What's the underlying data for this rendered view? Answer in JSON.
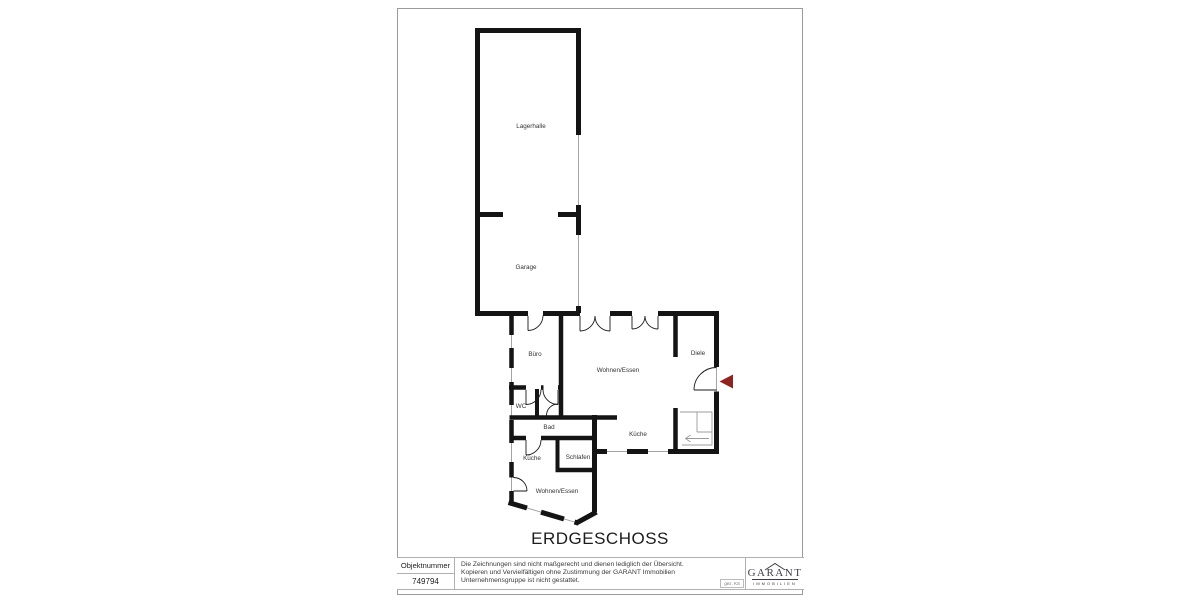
{
  "title": "ERDGESCHOSS",
  "rooms": {
    "lagerhalle": "Lagerhalle",
    "garage": "Garage",
    "buero": "Büro",
    "wohnen_essen": "Wohnen/Essen",
    "diele": "Diele",
    "wc": "WC",
    "bad": "Bad",
    "kueche_links": "Küche",
    "schlafen": "Schlafen",
    "kueche_rechts": "Küche",
    "wohnen_essen_unten": "Wohnen/Essen"
  },
  "title_block": {
    "object_number_label": "Objektnummer",
    "object_number": "749794",
    "disclaimer": {
      "line1": "Die Zeichnungen sind nicht maßgerecht und dienen lediglich der Übersicht.",
      "line2": "Kopieren und Vervielfältigen ohne Zustimmung der GARANT Immobilien",
      "line3": "Unternehmensgruppe ist nicht gestattet."
    },
    "drawn_by": "gez. KS",
    "logo": {
      "name": "GARANT",
      "subtitle": "IMMOBILIEN"
    }
  },
  "colors": {
    "wall": "#141414",
    "thin_line": "#a3a3a3",
    "door_line": "#1a1a1a",
    "stair_line": "#9c9c9c",
    "entrance_arrow": "#8e2420",
    "page_border": "#9a9a9a"
  }
}
